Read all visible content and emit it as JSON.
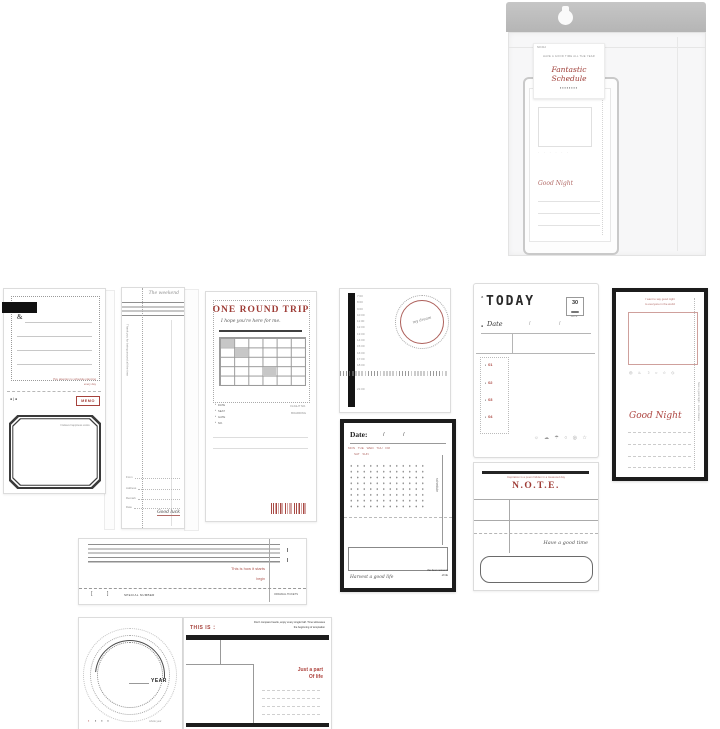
{
  "colors": {
    "accent_red": "#9e3c36",
    "soft_red": "#b26a66",
    "ink": "#1c1c1c",
    "paper_border": "#dcdcdc",
    "bag_gray": "#bdbdbd"
  },
  "package": {
    "code": "NO.012",
    "arc_text": "HAVE A GOOD TIME ALL THE YEAR",
    "title": "Fantastic Schedule",
    "marks": "▪▪▪▪▪▪▪▪",
    "pad": {
      "top_note": "sweet dreams tonight",
      "dots_row": "· · · · · ·",
      "script": "Good Night"
    }
  },
  "memo": {
    "ampersand": "&",
    "red_note1": "Pay attention to schedule planning",
    "red_note2": "every day",
    "marks": "● | ●",
    "chip": "MEMO",
    "frame_note": "I believe happiness exists"
  },
  "bookmark": {
    "script_title": "The weekend",
    "vertical_text": "Thank you for being around all the time",
    "fields": [
      "From",
      "Address",
      "Remark",
      "Date"
    ],
    "signature": "Good luck"
  },
  "round_trip": {
    "title": "ONE ROUND TRIP",
    "subtitle": "I hope you're here for me.",
    "bullets": [
      "DATE",
      "SEAT",
      "GATE",
      "NO."
    ],
    "right_labels": [
      "FLIGHT NO.",
      "BOARDING"
    ]
  },
  "timeline": {
    "times": "7:00\n8:00\n9:00\n10:00\n11:00\n12:00\n13:00\n14:00\n15:00\n16:00\n17:00\n18:00",
    "late_time": "21:00",
    "circle_text": "my dream"
  },
  "today": {
    "prefix": "a",
    "title": "TODAY",
    "stamp_value": "30",
    "stamp_label": "DATE",
    "bullet": "●",
    "date_label": "Date",
    "slash1": "/",
    "slash2": "/",
    "task_bullet": "▪",
    "tasks": [
      "01",
      "02",
      "03",
      "04"
    ],
    "icons": "☼ ☁ ☂ ○ ◎ ☆"
  },
  "good_night": {
    "note1": "I want to say good night",
    "note2": "to everyone in the world",
    "icons": "◎ ♨ ☽ ○ ☆ ◇",
    "title": "Good Night",
    "side_text": "have a good night · sweet dreams"
  },
  "date_card": {
    "label": "Date:",
    "slash1": "/",
    "slash2": "/",
    "week1": "MON TUE WED THU FRI",
    "week2": "SAT SUN",
    "side_text": "schedule",
    "script": "Harvest a good life",
    "note1": "the best moments",
    "note2": "of life"
  },
  "note_card": {
    "header_note": "Inspiration is a poem hidden in a treasured day",
    "title": "N.O.T.E.",
    "script": "Have a good time"
  },
  "ticket": {
    "red1": "This is how it starts",
    "red2": "begin",
    "bracket_open": "[",
    "bracket_close": "]",
    "left_label": "SPECIAL NUMBER",
    "stub_label": "ORIGINAL TICKETS"
  },
  "year_card": {
    "title": "YEAR",
    "dot_red": "▪",
    "dots": "▪ ▪ ▪",
    "corner_note": "whole year"
  },
  "this_is": {
    "title": "THIS IS ：",
    "note1": "Don't compare hearts, enjoy every single half. Time witnesses",
    "note2": "the beginning of temptation",
    "line1": "Just a part",
    "line2": "Of life"
  }
}
